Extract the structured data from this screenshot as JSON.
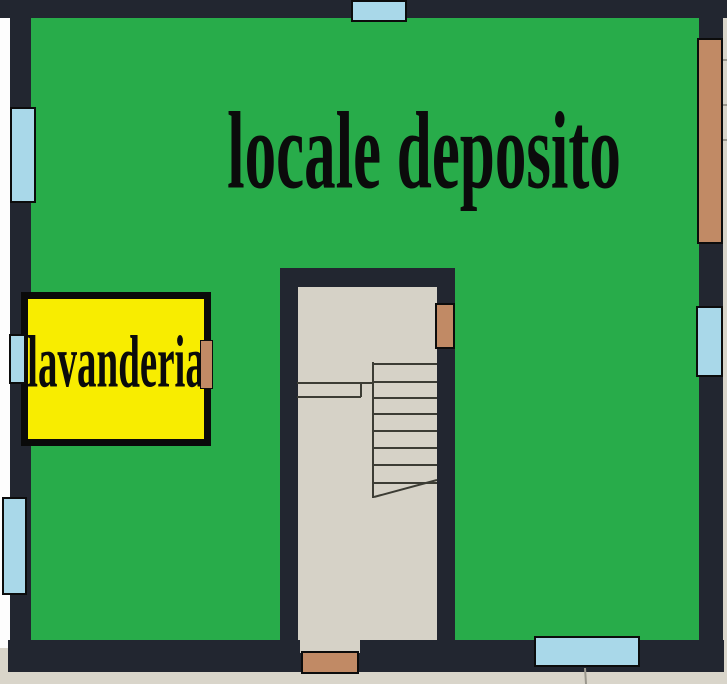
{
  "rooms": {
    "deposito": {
      "label": "locale deposito"
    },
    "lavanderia": {
      "label": "lavanderia"
    }
  },
  "features": {
    "stairwell": "stair-flight-with-landing",
    "window_count": 6,
    "door_count": 4
  },
  "colors": {
    "green": "#28ac4a",
    "yellow": "#f8ed00",
    "blue": "#a9d8e9",
    "brown": "#c18a65",
    "wall": "#222630",
    "floor": "#d6d2c7",
    "outside": "#d9d5ca",
    "margin": "#fdfdfd",
    "ink": "#0b0b0b",
    "line": "#3c3c34"
  }
}
